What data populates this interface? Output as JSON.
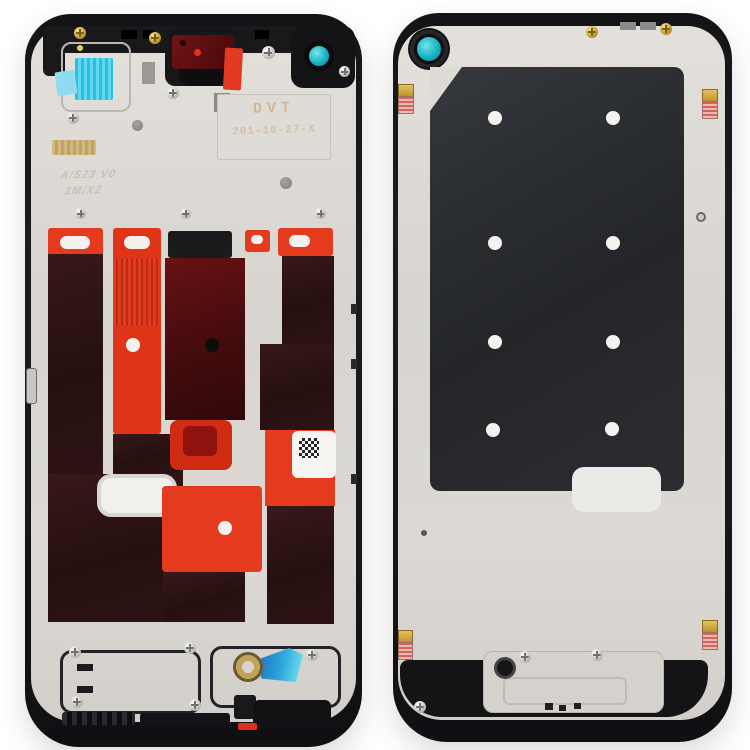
{
  "image_type": "product-photo",
  "subject": "Smartphone LCD middle frame bezel housing, front and rear views, on white background",
  "background_color": "#ffffff",
  "colors": {
    "bg": "#ffffff",
    "frame-black": "#17171a",
    "plate-silver": "#d9d6d1",
    "adhesive-red": "#e43a1e",
    "adhesive-dark": "#2e1315",
    "graphite": "#2b2d30",
    "teal-lens": "#14aec2",
    "cyan-sticker": "#35c6e8",
    "gold": "#c9a23a",
    "pink-tab": "#e8aaa4",
    "blue-film": "#2a8fd0",
    "red-accent": "#dd2f1c"
  },
  "front_frame": {
    "label": "front view - LCD middle frame with adhesive strips",
    "markings": {
      "plate_code_line1": "DVT",
      "plate_code_line2": "201-10-27-X",
      "etch_line1": "A/S23 V0",
      "etch_line2": "1M/X2"
    }
  },
  "back_frame": {
    "label": "rear view - middle plate with graphite thermal sheet"
  }
}
